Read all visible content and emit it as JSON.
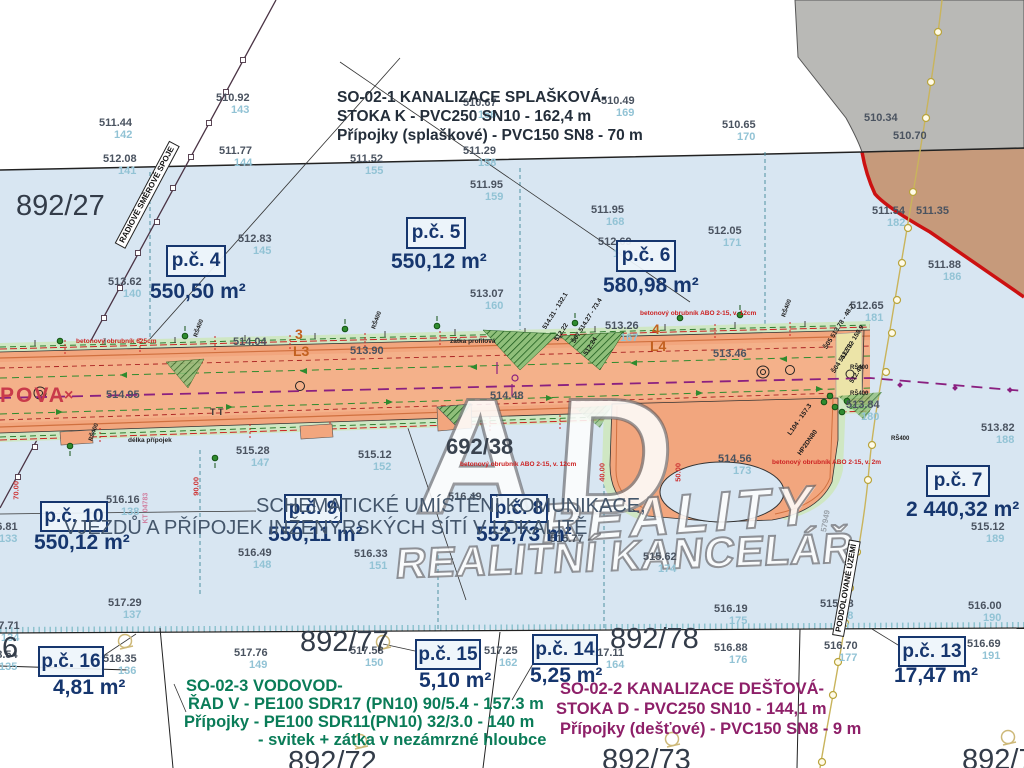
{
  "title_blocks": {
    "so021": {
      "l1": "SO-02-1 KANALIZACE SPLAŠKOVÁ-",
      "l2": "STOKA K - PVC250 SN10 - 162,4 m",
      "l3": "Přípojky (splaškové) - PVC150 SN8 - 70 m"
    },
    "schematic": {
      "l1": "SCHEMATICKÉ UMÍSTĚNÍ KOMUNIKACE,",
      "l2": "VJEZDŮ A PŘÍPOJEK INŽENÝRSKÝCH SÍTÍ V LOKALITĚ"
    },
    "so023": {
      "l1": "SO-02-3 VODOVOD-",
      "l2": "ŘAD V - PE100 SDR17 (PN10) 90/5.4 - 157.3 m",
      "l3": "Přípojky  - PE100 SDR11(PN10) 32/3.0 - 140 m",
      "l4": "- svitek + zátka v nezámrzné hloubce"
    },
    "so022": {
      "l1": "SO-02-2 KANALIZACE  DEŠŤOVÁ-",
      "l2": "STOKA D - PVC250 SN10 - 144,1 m",
      "l3": "Přípojky (dešťové) - PVC150 SN8 - 9 m"
    }
  },
  "watermark": {
    "l1": "AD",
    "l2": "REALITY",
    "l3": "REALITNÍ KANCELÁŘ"
  },
  "colors": {
    "parcel_fill": "#d8e6f2",
    "road_fill": "#f2a67e",
    "verge_green": "#cfe7c3",
    "gray_area": "#b9b9b6",
    "tan_area": "#c69a7b",
    "red_boundary": "#cc1111",
    "navy": "#16366e",
    "teal_id": "#92c3d5",
    "purple_axis": "#8a2080",
    "survey_yellow": "#c9b45c",
    "green_text": "#0a7c58",
    "purple_text": "#8e2069"
  },
  "parcels": [
    {
      "id": "p.č. 4",
      "area": "550,50 m²",
      "bx": 166,
      "by": 245,
      "bw": 56,
      "bh": 28,
      "ax": 150,
      "ay": 280
    },
    {
      "id": "p.č. 5",
      "area": "550,12 m²",
      "bx": 406,
      "by": 217,
      "bw": 56,
      "bh": 28,
      "ax": 391,
      "ay": 250
    },
    {
      "id": "p.č. 6",
      "area": "580,98 m²",
      "bx": 616,
      "by": 240,
      "bw": 56,
      "bh": 28,
      "ax": 603,
      "ay": 274
    },
    {
      "id": "p.č. 7",
      "area": "2 440,32 m²",
      "bx": 926,
      "by": 465,
      "bw": 60,
      "bh": 28,
      "ax": 906,
      "ay": 498
    },
    {
      "id": "p.č. 10",
      "area": "550,12 m²",
      "bx": 40,
      "by": 501,
      "bw": 64,
      "bh": 27,
      "ax": 34,
      "ay": 531
    },
    {
      "id": "p.č. 9",
      "area": "550,11 m²",
      "bx": 284,
      "by": 494,
      "bw": 54,
      "bh": 25,
      "ax": 268,
      "ay": 523
    },
    {
      "id": "p.č. 8",
      "area": "552,73 m²",
      "bx": 490,
      "by": 494,
      "bw": 54,
      "bh": 25,
      "ax": 476,
      "ay": 523
    },
    {
      "id": "p.č. 16",
      "area": "4,81 m²",
      "bx": 38,
      "by": 646,
      "bw": 62,
      "bh": 27,
      "ax": 53,
      "ay": 676
    },
    {
      "id": "p.č. 15",
      "area": "5,10 m²",
      "bx": 415,
      "by": 639,
      "bw": 62,
      "bh": 27,
      "ax": 419,
      "ay": 669
    },
    {
      "id": "p.č. 14",
      "area": "5,25 m²",
      "bx": 532,
      "by": 634,
      "bw": 62,
      "bh": 27,
      "ax": 530,
      "ay": 664
    },
    {
      "id": "p.č. 13",
      "area": "17,47 m²",
      "bx": 898,
      "by": 636,
      "bw": 64,
      "bh": 27,
      "ax": 894,
      "ay": 664
    }
  ],
  "labels": [
    {
      "k": "elev",
      "t": "510.92",
      "s": "143",
      "x": 216,
      "y": 93
    },
    {
      "k": "elev",
      "t": "511.44",
      "s": "142",
      "x": 99,
      "y": 118
    },
    {
      "k": "elev",
      "t": "512.08",
      "s": "141",
      "x": 103,
      "y": 154
    },
    {
      "k": "elev",
      "t": "511.77",
      "s": "144",
      "x": 219,
      "y": 146
    },
    {
      "k": "elev",
      "t": "510.67",
      "s": "156",
      "x": 463,
      "y": 98
    },
    {
      "k": "elev",
      "t": "510.49",
      "s": "169",
      "x": 601,
      "y": 96
    },
    {
      "k": "elev",
      "t": "510.65",
      "s": "170",
      "x": 722,
      "y": 120
    },
    {
      "k": "elev",
      "t": "510.34",
      "x": 864,
      "y": 113
    },
    {
      "k": "elev",
      "t": "510.70",
      "x": 893,
      "y": 131
    },
    {
      "k": "elev",
      "t": "511.52",
      "s": "155",
      "x": 350,
      "y": 154
    },
    {
      "k": "elev",
      "t": "511.29",
      "s": "158",
      "x": 463,
      "y": 146
    },
    {
      "k": "elev",
      "t": "511.95",
      "s": "159",
      "x": 470,
      "y": 180
    },
    {
      "k": "elev",
      "t": "511.95",
      "s": "168",
      "x": 591,
      "y": 205
    },
    {
      "k": "elev",
      "t": "512.83",
      "s": "145",
      "x": 238,
      "y": 234
    },
    {
      "k": "elev",
      "t": "512.69",
      "s": "154",
      "x": 598,
      "y": 237
    },
    {
      "k": "elev",
      "t": "513.62",
      "s": "140",
      "x": 108,
      "y": 277
    },
    {
      "k": "elev",
      "t": "513.07",
      "s": "160",
      "x": 470,
      "y": 289
    },
    {
      "k": "elev",
      "t": "512.05",
      "s": "171",
      "x": 708,
      "y": 226
    },
    {
      "k": "elev",
      "t": "511.54",
      "s": "182",
      "x": 872,
      "y": 206
    },
    {
      "k": "elev",
      "t": "511.35",
      "x": 916,
      "y": 206
    },
    {
      "k": "elev",
      "t": "511.88",
      "s": "186",
      "x": 928,
      "y": 260
    },
    {
      "k": "elev",
      "t": "512.65",
      "s": "181",
      "x": 850,
      "y": 301
    },
    {
      "k": "elev",
      "t": "514.04",
      "x": 233,
      "y": 337
    },
    {
      "k": "elev",
      "t": "513.90",
      "x": 350,
      "y": 346
    },
    {
      "k": "elev",
      "t": "513.26",
      "s": "167",
      "x": 605,
      "y": 321
    },
    {
      "k": "elev",
      "t": "513.46",
      "x": 713,
      "y": 349
    },
    {
      "k": "elev",
      "t": "514.48",
      "x": 490,
      "y": 391
    },
    {
      "k": "elev",
      "t": "514.95",
      "x": 106,
      "y": 390
    },
    {
      "k": "elev",
      "t": "515.28",
      "s": "147",
      "x": 236,
      "y": 446
    },
    {
      "k": "elev",
      "t": "515.12",
      "s": "152",
      "x": 358,
      "y": 450
    },
    {
      "k": "elev",
      "t": "514.56",
      "s": "173",
      "x": 718,
      "y": 454
    },
    {
      "k": "elev",
      "t": "513.84",
      "s": "180",
      "x": 846,
      "y": 400
    },
    {
      "k": "elev",
      "t": "513.82",
      "s": "188",
      "x": 981,
      "y": 423
    },
    {
      "k": "elev",
      "t": "515.12",
      "s": "189",
      "x": 971,
      "y": 522
    },
    {
      "k": "elev",
      "t": "516.16",
      "s": "138",
      "x": 106,
      "y": 495
    },
    {
      "k": "elev",
      "t": "516.81",
      "s": "133",
      "x": -16,
      "y": 522
    },
    {
      "k": "elev",
      "t": "516.49",
      "s": "148",
      "x": 238,
      "y": 548
    },
    {
      "k": "elev",
      "t": "516.33",
      "s": "151",
      "x": 354,
      "y": 549
    },
    {
      "k": "elev",
      "t": "516.49",
      "x": 448,
      "y": 492
    },
    {
      "k": "elev",
      "t": "515.77",
      "x": 550,
      "y": 534
    },
    {
      "k": "elev",
      "t": "515.62",
      "s": "174",
      "x": 643,
      "y": 552
    },
    {
      "k": "elev",
      "t": "515.98",
      "s": "178",
      "x": 820,
      "y": 599
    },
    {
      "k": "elev",
      "t": "516.19",
      "s": "175",
      "x": 714,
      "y": 604
    },
    {
      "k": "elev",
      "t": "516.00",
      "s": "190",
      "x": 968,
      "y": 601
    },
    {
      "k": "elev",
      "t": "517.29",
      "s": "137",
      "x": 108,
      "y": 598
    },
    {
      "k": "elev",
      "t": "517.71",
      "s": "134",
      "x": -14,
      "y": 621
    },
    {
      "k": "elev",
      "t": "518.54",
      "s": "135",
      "x": -16,
      "y": 650
    },
    {
      "k": "elev",
      "t": "518.35",
      "s": "136",
      "x": 103,
      "y": 654
    },
    {
      "k": "elev",
      "t": "517.76",
      "s": "149",
      "x": 234,
      "y": 648
    },
    {
      "k": "elev",
      "t": "517.58",
      "s": "150",
      "x": 350,
      "y": 646
    },
    {
      "k": "elev",
      "t": "517.25",
      "s": "162",
      "x": 484,
      "y": 646
    },
    {
      "k": "elev",
      "t": "517.11",
      "s": "164",
      "x": 591,
      "y": 648
    },
    {
      "k": "elev",
      "t": "516.88",
      "s": "176",
      "x": 714,
      "y": 643
    },
    {
      "k": "elev",
      "t": "516.70",
      "s": "177",
      "x": 824,
      "y": 641
    },
    {
      "k": "elev",
      "t": "516.69",
      "s": "191",
      "x": 967,
      "y": 639
    },
    {
      "k": "big",
      "t": "892/27",
      "x": 16,
      "y": 192
    },
    {
      "k": "big",
      "t": "892/77",
      "x": 300,
      "y": 628
    },
    {
      "k": "big",
      "t": "892/78",
      "x": 610,
      "y": 625
    },
    {
      "k": "big",
      "t": "892/72",
      "x": 288,
      "y": 748
    },
    {
      "k": "big",
      "t": "892/73",
      "x": 602,
      "y": 746
    },
    {
      "k": "big",
      "t": "892/7",
      "x": 962,
      "y": 746
    },
    {
      "k": "big",
      "t": "6",
      "x": 2,
      "y": 634
    },
    {
      "k": "big2",
      "t": "692/38",
      "x": 446,
      "y": 436
    },
    {
      "k": "street",
      "t": "POVA",
      "x": 0,
      "y": 385
    },
    {
      "k": "streetx",
      "t": "×",
      "x": 64,
      "y": 388
    },
    {
      "k": "lorange",
      "t": "3",
      "x": 295,
      "y": 327
    },
    {
      "k": "lorange",
      "t": "L3",
      "x": 293,
      "y": 344
    },
    {
      "k": "lorange",
      "t": "4",
      "x": 652,
      "y": 322
    },
    {
      "k": "lorange",
      "t": "L4",
      "x": 650,
      "y": 339
    },
    {
      "k": "tred",
      "t": "betonový obrubník 625cm",
      "x": 76,
      "y": 339
    },
    {
      "k": "tred",
      "t": "betonový obrubník ABO 2-15, v. 12cm",
      "x": 640,
      "y": 311
    },
    {
      "k": "tred",
      "t": "betonový obrubník ABO 2-15, v. 12cm",
      "x": 460,
      "y": 462
    },
    {
      "k": "tred",
      "t": "betonový obrubník ABO 2-15, v. 2m",
      "x": 772,
      "y": 460
    },
    {
      "k": "tblk",
      "t": "zátka profilová",
      "x": 450,
      "y": 339
    },
    {
      "k": "tblk",
      "t": "délka přípojek",
      "x": 128,
      "y": 438
    },
    {
      "k": "tinyT",
      "t": "T T",
      "x": 210,
      "y": 408
    },
    {
      "k": "trs",
      "t": "RŠ400",
      "x": 196,
      "y": 334,
      "r": -70
    },
    {
      "k": "trs",
      "t": "RŠ400",
      "x": 374,
      "y": 326,
      "r": -70
    },
    {
      "k": "trs",
      "t": "RŠ400",
      "x": 784,
      "y": 314,
      "r": -70
    },
    {
      "k": "trs",
      "t": "RŠ400",
      "x": 91,
      "y": 438,
      "r": -70
    },
    {
      "k": "trs",
      "t": "RŠ400",
      "x": 850,
      "y": 365
    },
    {
      "k": "trs",
      "t": "RŠ400",
      "x": 850,
      "y": 391
    },
    {
      "k": "trs",
      "t": "RŠ400",
      "x": 891,
      "y": 436
    },
    {
      "k": "rdim",
      "t": "70.00",
      "x": 16,
      "y": 496,
      "r": -90
    },
    {
      "k": "rdim",
      "t": "90.00",
      "x": 196,
      "y": 492,
      "r": -90
    },
    {
      "k": "rdim",
      "t": "40.00",
      "x": 602,
      "y": 478,
      "r": -90
    },
    {
      "k": "rdim",
      "t": "50.00",
      "x": 678,
      "y": 478,
      "r": -90
    },
    {
      "k": "rpink",
      "t": "KT 04783",
      "x": 146,
      "y": 520,
      "r": -90
    },
    {
      "k": "rgray",
      "t": "57949",
      "x": 824,
      "y": 528,
      "r": -80
    },
    {
      "k": "rsh",
      "t": "Š05 513.78 - 48.7",
      "x": 826,
      "y": 346,
      "r": -58
    },
    {
      "k": "rsh",
      "t": "512.52",
      "x": 843,
      "y": 356,
      "r": -58
    },
    {
      "k": "rsh",
      "t": "Š04 513.73 - 158.9",
      "x": 834,
      "y": 370,
      "r": -58
    },
    {
      "k": "rsh",
      "t": "512.49",
      "x": 852,
      "y": 380,
      "r": -58
    },
    {
      "k": "rsh",
      "t": "514.31 - 132.1",
      "x": 545,
      "y": 326,
      "r": -58
    },
    {
      "k": "rsh",
      "t": "512.22",
      "x": 557,
      "y": 338,
      "r": -58
    },
    {
      "k": "rsh",
      "t": "Š07 514.27 - 73.4",
      "x": 574,
      "y": 340,
      "r": -58
    },
    {
      "k": "rsh",
      "t": "512.24",
      "x": 586,
      "y": 352,
      "r": -58
    },
    {
      "k": "rsh",
      "t": "L104 - 157.3",
      "x": 790,
      "y": 432,
      "r": -55
    },
    {
      "k": "rsh",
      "t": "HP2DN80",
      "x": 800,
      "y": 452,
      "r": -55
    },
    {
      "k": "rbox",
      "t": "RADIOVÉ SMĚROVÉ SPOJE",
      "x": 120,
      "y": 240,
      "r": -62
    },
    {
      "k": "rbox",
      "t": "PODDOLOVANÉ ÚZEMÍ",
      "x": 838,
      "y": 630,
      "r": -80
    }
  ]
}
